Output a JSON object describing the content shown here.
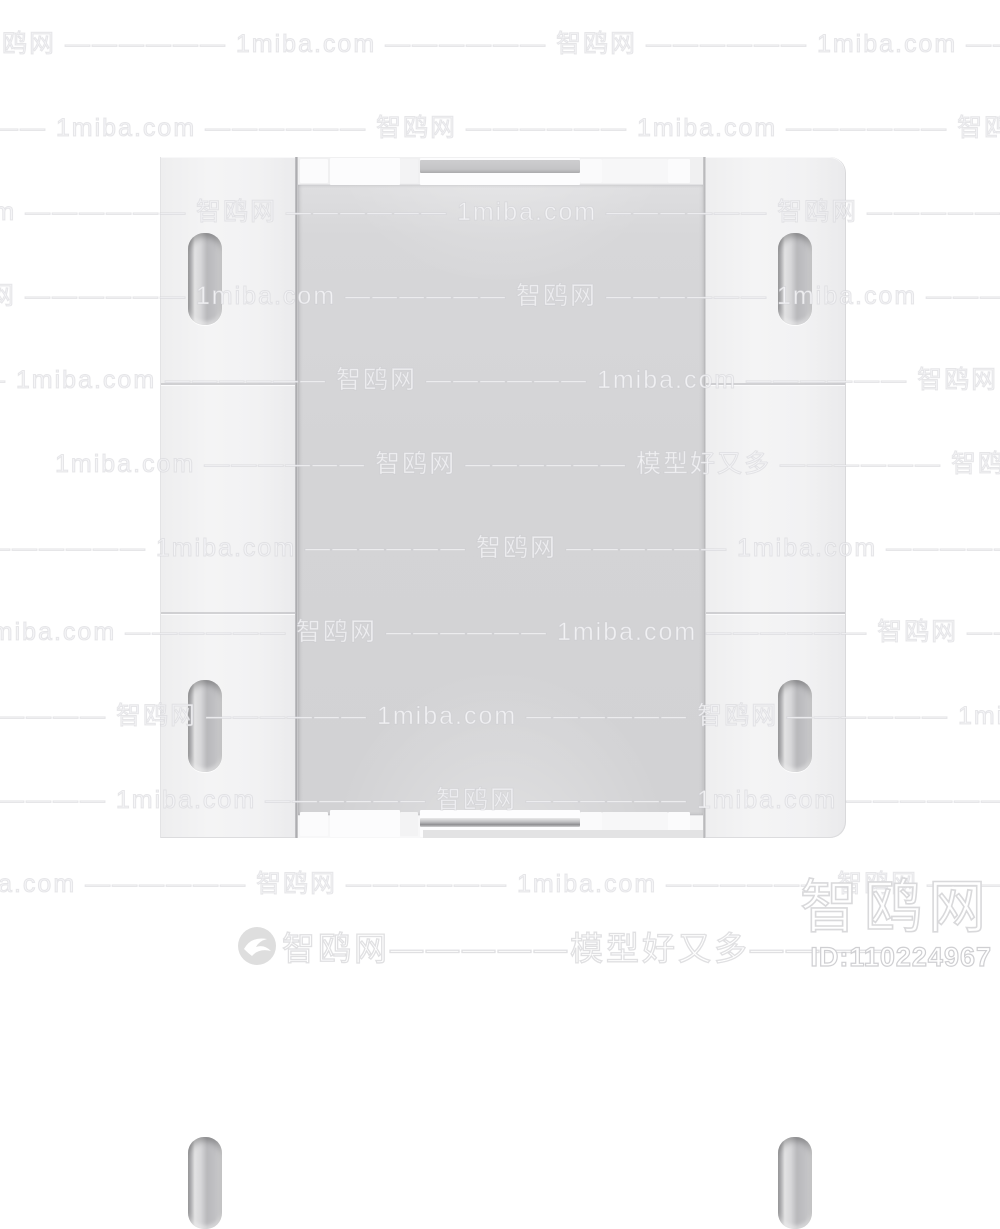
{
  "colors": {
    "page-bg": "#ffffff",
    "panel-gray": "#d4d4d6",
    "outline-gray": "#e0e0e2",
    "logo-gray": "#dedede"
  },
  "watermark": {
    "row_text": "智鸥网 —————— 1miba.com —————— 智鸥网 —————— 1miba.com —————— 智鸥网 —————— 1miba.com",
    "row_alt_text": "1miba.com —————— 智鸥网 —————— 模型好又多 —————— 智鸥网 —————— 1miba.com",
    "rows": [
      {
        "y": 24,
        "x": -25
      },
      {
        "y": 108,
        "x": -205
      },
      {
        "y": 192,
        "x": -385
      },
      {
        "y": 276,
        "x": -65
      },
      {
        "y": 360,
        "x": -245
      },
      {
        "y": 444,
        "x": 55,
        "alt": true
      },
      {
        "y": 528,
        "x": -105
      },
      {
        "y": 612,
        "x": -285
      },
      {
        "y": 696,
        "x": -465
      },
      {
        "y": 780,
        "x": -145
      },
      {
        "y": 864,
        "x": -325
      }
    ],
    "banner_text": "智鸥网—————模型好又多————",
    "corner_site": "智鸥网",
    "model_id": "ID:110224967",
    "bird_icon": "bird-logo-icon"
  },
  "product": {
    "name": "white-wall-switch-panel",
    "left_column_slots": 3,
    "right_column_slots": 3
  }
}
